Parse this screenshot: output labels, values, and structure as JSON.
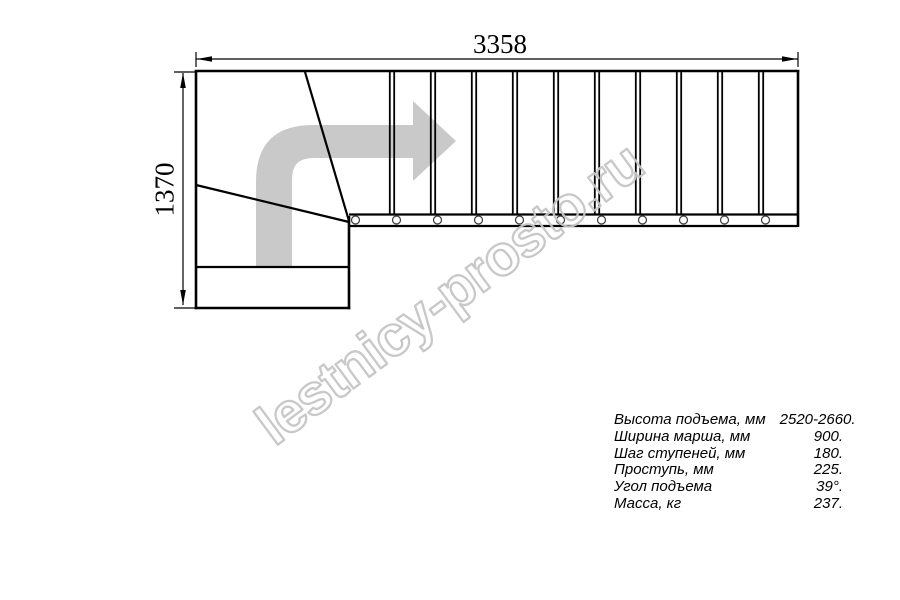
{
  "dimensions": {
    "width_label": "3358",
    "height_label": "1370"
  },
  "watermark": {
    "text": "lestnicy-prosto.ru",
    "color": "#c6c6c6"
  },
  "drawing": {
    "arrow_color": "#c9c9c9",
    "line_color": "#000000",
    "tread_count": 11,
    "divider_count": 10,
    "circle_count": 11
  },
  "specs": {
    "rows": [
      {
        "label": "Высота подъема, мм",
        "value": "2520-2660."
      },
      {
        "label": "Ширина марша, мм",
        "value": "900."
      },
      {
        "label": "Шаг ступеней, мм",
        "value": "180."
      },
      {
        "label": "Проступь, мм",
        "value": "225."
      },
      {
        "label": "Угол подъема",
        "value": "39°."
      },
      {
        "label": "Масса, кг",
        "value": "237."
      }
    ]
  }
}
